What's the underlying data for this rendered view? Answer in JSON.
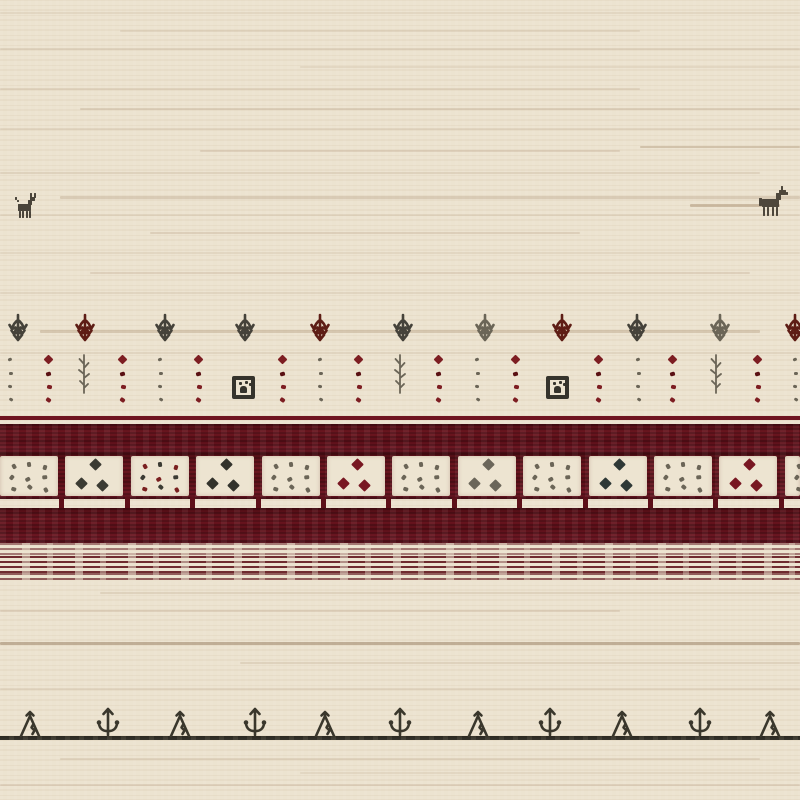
{
  "scene": {
    "type": "photograph",
    "subject": "Close-up detail of a handwoven Gabbeh-style wool rug with tribal motifs",
    "palette": {
      "cream": "#ece3d0",
      "weave_tan": "#8d6b48",
      "maroon": "#5f1119",
      "maroon_bright": "#7c1f2c",
      "charcoal": "#45423a",
      "gray": "#6b6557",
      "rust": "#5e1d15",
      "red_dot": "#7d1d22",
      "line_dark": "#3a372c"
    }
  },
  "animals": [
    {
      "kind": "goat",
      "x": 13,
      "y": 193,
      "w": 26,
      "h": 32,
      "color": "#4a443a"
    },
    {
      "kind": "horse",
      "x": 757,
      "y": 185,
      "w": 35,
      "h": 33,
      "color": "#4e473c"
    }
  ],
  "tree_row": {
    "top": 313,
    "motifs": [
      {
        "x": 18,
        "color": "charcoal"
      },
      {
        "x": 85,
        "color": "rust"
      },
      {
        "x": 165,
        "color": "charcoal"
      },
      {
        "x": 245,
        "color": "charcoal"
      },
      {
        "x": 320,
        "color": "rust"
      },
      {
        "x": 403,
        "color": "charcoal"
      },
      {
        "x": 485,
        "color": "gray"
      },
      {
        "x": 562,
        "color": "rust"
      },
      {
        "x": 637,
        "color": "charcoal"
      },
      {
        "x": 720,
        "color": "gray"
      },
      {
        "x": 795,
        "color": "rust"
      }
    ]
  },
  "dot_row": {
    "top": 356,
    "columns": [
      {
        "x": 10,
        "kind": "dots",
        "color": "gray"
      },
      {
        "x": 48,
        "kind": "diamond",
        "color": "red_dot"
      },
      {
        "x": 84,
        "kind": "plant",
        "color": "gray"
      },
      {
        "x": 122,
        "kind": "diamond",
        "color": "red_dot"
      },
      {
        "x": 160,
        "kind": "dots",
        "color": "gray"
      },
      {
        "x": 198,
        "kind": "diamond",
        "color": "red_dot"
      },
      {
        "x": 244,
        "kind": "box",
        "color": "charcoal"
      },
      {
        "x": 282,
        "kind": "diamond",
        "color": "red_dot"
      },
      {
        "x": 320,
        "kind": "dots",
        "color": "gray"
      },
      {
        "x": 358,
        "kind": "diamond",
        "color": "red_dot"
      },
      {
        "x": 400,
        "kind": "plant",
        "color": "gray"
      },
      {
        "x": 438,
        "kind": "diamond",
        "color": "red_dot"
      },
      {
        "x": 477,
        "kind": "dots",
        "color": "gray"
      },
      {
        "x": 515,
        "kind": "diamond",
        "color": "red_dot"
      },
      {
        "x": 558,
        "kind": "box",
        "color": "charcoal"
      },
      {
        "x": 598,
        "kind": "diamond",
        "color": "red_dot"
      },
      {
        "x": 638,
        "kind": "dots",
        "color": "gray"
      },
      {
        "x": 672,
        "kind": "diamond",
        "color": "red_dot"
      },
      {
        "x": 716,
        "kind": "plant",
        "color": "gray"
      },
      {
        "x": 757,
        "kind": "diamond",
        "color": "red_dot"
      },
      {
        "x": 795,
        "kind": "dots",
        "color": "gray"
      }
    ]
  },
  "band_section": {
    "thin_line": {
      "y": 416,
      "h": 4
    },
    "top_band": {
      "y": 424,
      "h": 29
    },
    "squares": {
      "y": 453,
      "h": 46,
      "pitch": 65.4,
      "cell_w": 58,
      "cells": [
        {
          "kind": "dots",
          "color": "gray"
        },
        {
          "kind": "diamonds",
          "color": "#3b3b33"
        },
        {
          "kind": "dots",
          "color": "mixed"
        },
        {
          "kind": "diamonds",
          "color": "#33332c"
        },
        {
          "kind": "dots",
          "color": "gray"
        },
        {
          "kind": "diamonds",
          "color": "#781722"
        },
        {
          "kind": "dots",
          "color": "gray"
        },
        {
          "kind": "diamonds",
          "color": "#6b665a"
        },
        {
          "kind": "dots",
          "color": "gray"
        },
        {
          "kind": "diamonds",
          "color": "#2e3836"
        },
        {
          "kind": "dots",
          "color": "gray"
        },
        {
          "kind": "diamonds",
          "color": "#781722"
        },
        {
          "kind": "dots",
          "color": "gray"
        }
      ]
    },
    "ticks": {
      "y": 497,
      "h": 12
    },
    "bottom_band": {
      "y": 508,
      "h": 35
    },
    "striated_zones": [
      {
        "y": 543,
        "h": 13,
        "opacity": 0.55
      },
      {
        "y": 556,
        "h": 17,
        "opacity": 0.95
      },
      {
        "y": 573,
        "h": 9,
        "opacity": 0.7
      }
    ]
  },
  "bottom_border": {
    "line_y": 736,
    "line_h": 4,
    "motifs": [
      {
        "x": 30,
        "kind": "figure"
      },
      {
        "x": 108,
        "kind": "anchor"
      },
      {
        "x": 180,
        "kind": "figure"
      },
      {
        "x": 255,
        "kind": "anchor"
      },
      {
        "x": 325,
        "kind": "figure"
      },
      {
        "x": 400,
        "kind": "anchor"
      },
      {
        "x": 478,
        "kind": "figure"
      },
      {
        "x": 550,
        "kind": "anchor"
      },
      {
        "x": 622,
        "kind": "figure"
      },
      {
        "x": 700,
        "kind": "anchor"
      },
      {
        "x": 770,
        "kind": "figure"
      }
    ]
  },
  "striations": [
    {
      "y": 12,
      "x": 0,
      "w": 800,
      "o": 0.1
    },
    {
      "y": 30,
      "x": 120,
      "w": 520,
      "o": 0.12
    },
    {
      "y": 48,
      "x": 0,
      "w": 800,
      "o": 0.15
    },
    {
      "y": 66,
      "x": 300,
      "w": 500,
      "o": 0.1
    },
    {
      "y": 88,
      "x": 0,
      "w": 640,
      "o": 0.14
    },
    {
      "y": 108,
      "x": 80,
      "w": 720,
      "o": 0.18
    },
    {
      "y": 128,
      "x": 0,
      "w": 800,
      "o": 0.12
    },
    {
      "y": 146,
      "x": 640,
      "w": 160,
      "o": 0.28
    },
    {
      "y": 150,
      "x": 200,
      "w": 420,
      "o": 0.16
    },
    {
      "y": 172,
      "x": 0,
      "w": 760,
      "o": 0.14
    },
    {
      "y": 196,
      "x": 60,
      "w": 740,
      "o": 0.2,
      "h": 3
    },
    {
      "y": 204,
      "x": 690,
      "w": 90,
      "o": 0.34,
      "h": 3
    },
    {
      "y": 214,
      "x": 0,
      "w": 800,
      "o": 0.12
    },
    {
      "y": 232,
      "x": 150,
      "w": 430,
      "o": 0.17
    },
    {
      "y": 252,
      "x": 0,
      "w": 800,
      "o": 0.1
    },
    {
      "y": 272,
      "x": 90,
      "w": 660,
      "o": 0.16
    },
    {
      "y": 292,
      "x": 0,
      "w": 800,
      "o": 0.12
    },
    {
      "y": 330,
      "x": 40,
      "w": 720,
      "o": 0.24,
      "h": 3
    },
    {
      "y": 352,
      "x": 0,
      "w": 800,
      "o": 0.12
    },
    {
      "y": 592,
      "x": 100,
      "w": 700,
      "o": 0.14
    },
    {
      "y": 610,
      "x": 0,
      "w": 620,
      "o": 0.16
    },
    {
      "y": 642,
      "x": 0,
      "w": 800,
      "o": 0.4,
      "h": 3,
      "c": "#7d5c3c"
    },
    {
      "y": 662,
      "x": 240,
      "w": 560,
      "o": 0.14
    },
    {
      "y": 688,
      "x": 0,
      "w": 800,
      "o": 0.12
    },
    {
      "y": 758,
      "x": 60,
      "w": 700,
      "o": 0.14
    },
    {
      "y": 772,
      "x": 300,
      "w": 500,
      "o": 0.1
    },
    {
      "y": 784,
      "x": 0,
      "w": 800,
      "o": 0.16
    }
  ]
}
